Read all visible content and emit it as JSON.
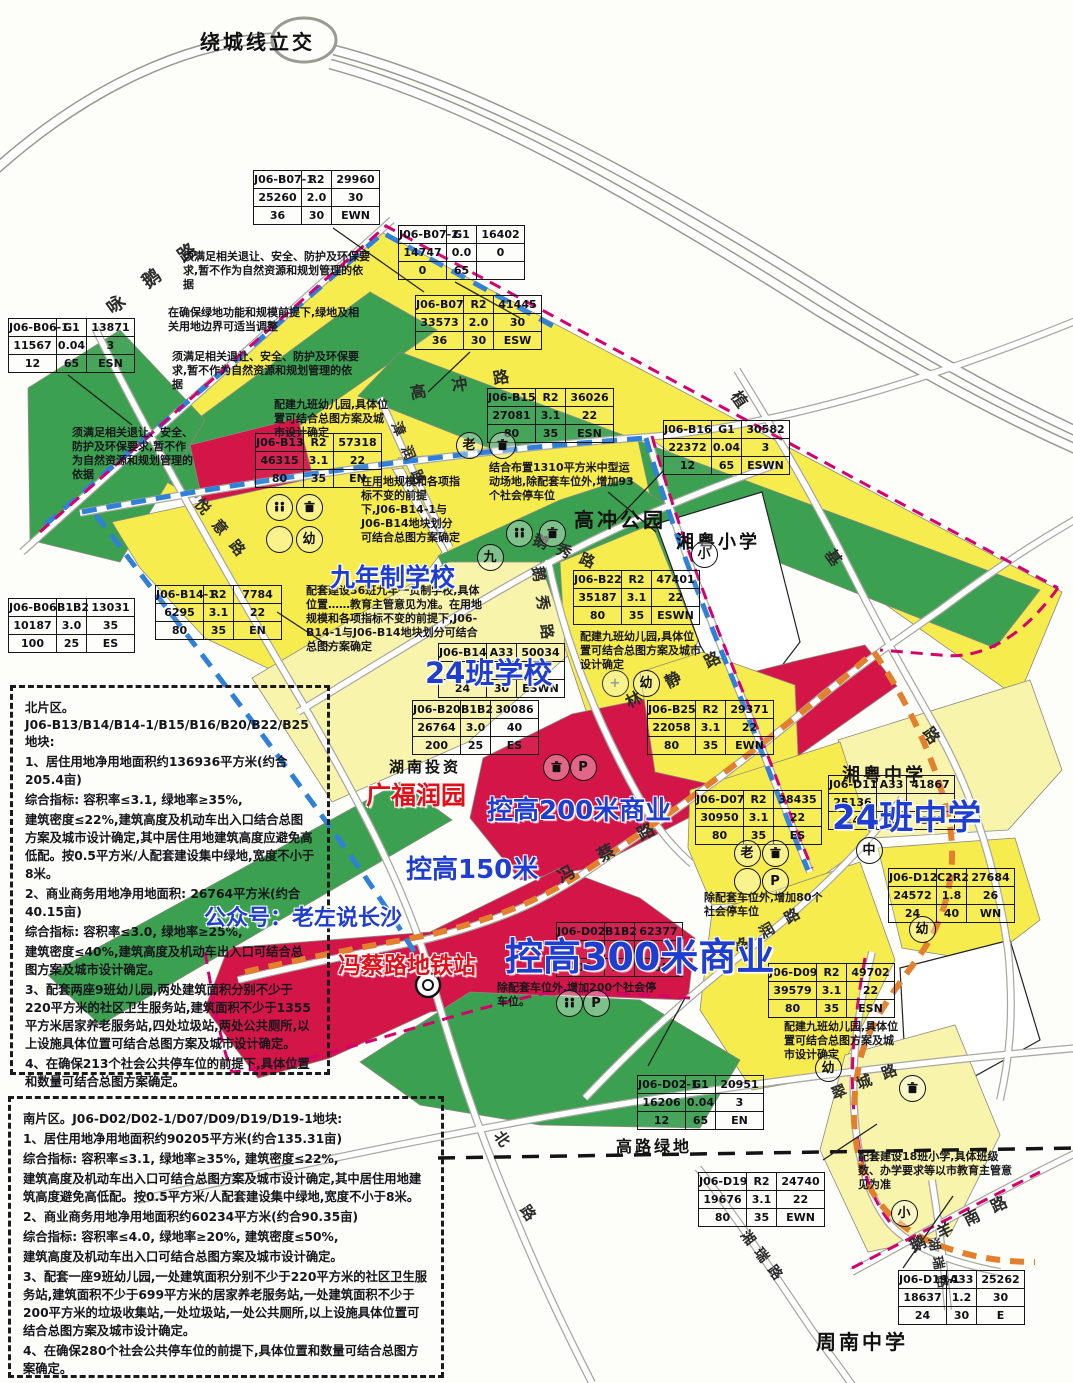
{
  "map_title": "绕城线立交",
  "colors": {
    "parcel_yellow": "#f7ec4d",
    "parcel_school": "#f8f4ac",
    "parcel_green": "#3ba050",
    "parcel_red": "#d31547",
    "boundary_blue": "#2f80d8",
    "boundary_pink": "#d4006e",
    "metro_orange": "#e2802e",
    "annotation_blue": "#1f3ed0",
    "annotation_red": "#e0101a"
  },
  "tables": [
    {
      "x": 253,
      "y": 170,
      "rows": [
        [
          "J06-B07-1",
          "R2",
          "29960"
        ],
        [
          "25260",
          "2.0",
          "30"
        ],
        [
          "36",
          "30",
          "EWN"
        ]
      ]
    },
    {
      "x": 398,
      "y": 225,
      "rows": [
        [
          "J06-B07-2",
          "G1",
          "16402"
        ],
        [
          "14747",
          "0.0",
          "0"
        ],
        [
          "0",
          "65",
          ""
        ]
      ]
    },
    {
      "x": 415,
      "y": 295,
      "rows": [
        [
          "J06-B07",
          "R2",
          "41445"
        ],
        [
          "33573",
          "2.0",
          "30"
        ],
        [
          "36",
          "30",
          "ESW"
        ]
      ]
    },
    {
      "x": 8,
      "y": 318,
      "rows": [
        [
          "J06-B06-1",
          "G1",
          "13871"
        ],
        [
          "11567",
          "0.04",
          "3"
        ],
        [
          "12",
          "65",
          "ESN"
        ]
      ]
    },
    {
      "x": 255,
      "y": 433,
      "rows": [
        [
          "J06-B13",
          "R2",
          "57318"
        ],
        [
          "46315",
          "3.1",
          "22"
        ],
        [
          "80",
          "35",
          "EN"
        ]
      ]
    },
    {
      "x": 487,
      "y": 388,
      "rows": [
        [
          "J06-B15",
          "R2",
          "36026"
        ],
        [
          "27081",
          "3.1",
          "22"
        ],
        [
          "80",
          "35",
          "ESN"
        ]
      ]
    },
    {
      "x": 663,
      "y": 420,
      "rows": [
        [
          "J06-B16",
          "G1",
          "30582"
        ],
        [
          "22372",
          "0.04",
          "3"
        ],
        [
          "12",
          "65",
          "ESWN"
        ]
      ]
    },
    {
      "x": 155,
      "y": 585,
      "rows": [
        [
          "J06-B14-1",
          "R2",
          "7784"
        ],
        [
          "6295",
          "3.1",
          "22"
        ],
        [
          "80",
          "35",
          "EN"
        ]
      ]
    },
    {
      "x": 8,
      "y": 598,
      "rows": [
        [
          "J06-B06",
          "B1B2",
          "13031"
        ],
        [
          "10187",
          "3.0",
          "35"
        ],
        [
          "100",
          "25",
          "ES"
        ]
      ]
    },
    {
      "x": 573,
      "y": 570,
      "rows": [
        [
          "J06-B22",
          "R2",
          "47401"
        ],
        [
          "35187",
          "3.1",
          "22"
        ],
        [
          "80",
          "35",
          "ESWN"
        ]
      ]
    },
    {
      "x": 438,
      "y": 643,
      "rows": [
        [
          "J06-B14",
          "A33",
          "50034"
        ],
        [
          "",
          "",
          ""
        ],
        [
          "24",
          "30",
          "ESWN"
        ]
      ]
    },
    {
      "x": 412,
      "y": 700,
      "rows": [
        [
          "J06-B20",
          "B1B2",
          "30086"
        ],
        [
          "26764",
          "3.0",
          "40"
        ],
        [
          "200",
          "25",
          "ES"
        ]
      ]
    },
    {
      "x": 647,
      "y": 700,
      "rows": [
        [
          "J06-B25",
          "R2",
          "29371"
        ],
        [
          "22058",
          "3.1",
          "22"
        ],
        [
          "80",
          "35",
          "EWN"
        ]
      ]
    },
    {
      "x": 695,
      "y": 790,
      "rows": [
        [
          "J06-D07",
          "R2",
          "38435"
        ],
        [
          "30950",
          "3.1",
          "22"
        ],
        [
          "80",
          "35",
          "ES"
        ]
      ]
    },
    {
      "x": 828,
      "y": 775,
      "rows": [
        [
          "J06-D11",
          "A33",
          "41867"
        ],
        [
          "25136",
          "",
          ""
        ],
        [
          "24",
          "30",
          "SW"
        ]
      ]
    },
    {
      "x": 888,
      "y": 868,
      "rows": [
        [
          "J06-D12",
          "C2R2",
          "27684"
        ],
        [
          "24572",
          "1.8",
          "26"
        ],
        [
          "24",
          "40",
          "WN"
        ]
      ]
    },
    {
      "x": 768,
      "y": 963,
      "rows": [
        [
          "J06-D09",
          "R2",
          "49702"
        ],
        [
          "39579",
          "3.1",
          "22"
        ],
        [
          "80",
          "35",
          "ESN"
        ]
      ]
    },
    {
      "x": 556,
      "y": 922,
      "rows": [
        [
          "J06-D02",
          "B1B2",
          "62377"
        ],
        [
          "",
          "",
          ""
        ],
        [
          "300",
          "20",
          "ESN"
        ]
      ]
    },
    {
      "x": 637,
      "y": 1075,
      "rows": [
        [
          "J06-D02-1",
          "G1",
          "20951"
        ],
        [
          "16206",
          "0.04",
          "3"
        ],
        [
          "12",
          "65",
          "EN"
        ]
      ]
    },
    {
      "x": 698,
      "y": 1172,
      "rows": [
        [
          "J06-D19",
          "R2",
          "24740"
        ],
        [
          "19676",
          "3.1",
          "22"
        ],
        [
          "80",
          "35",
          "EWN"
        ]
      ]
    },
    {
      "x": 898,
      "y": 1270,
      "rows": [
        [
          "J06-D19-1",
          "A33",
          "25262"
        ],
        [
          "18637",
          "1.2",
          "30"
        ],
        [
          "24",
          "30",
          "E"
        ]
      ]
    }
  ],
  "big_labels": [
    {
      "t": "九年制学校",
      "x": 330,
      "y": 558,
      "s": 25,
      "c": "blue"
    },
    {
      "t": "24班学校",
      "x": 425,
      "y": 650,
      "s": 29,
      "c": "blue"
    },
    {
      "t": "控高200米商业",
      "x": 487,
      "y": 790,
      "s": 26,
      "c": "blue"
    },
    {
      "t": "控高150米",
      "x": 406,
      "y": 849,
      "s": 26,
      "c": "blue"
    },
    {
      "t": "控高300米商业",
      "x": 505,
      "y": 926,
      "s": 38,
      "c": "blue"
    },
    {
      "t": "24班中学",
      "x": 832,
      "y": 790,
      "s": 34,
      "c": "blue"
    },
    {
      "t": "公众号：老左说长沙",
      "x": 204,
      "y": 900,
      "s": 22,
      "c": "blue"
    },
    {
      "t": "广福润园",
      "x": 366,
      "y": 776,
      "s": 25,
      "c": "red"
    },
    {
      "t": "冯蔡路地铁站",
      "x": 338,
      "y": 946,
      "s": 23,
      "c": "red"
    }
  ],
  "area_labels": [
    {
      "t": "绕城线立交",
      "x": 200,
      "y": 26,
      "s": 20
    },
    {
      "t": "高冲公园",
      "x": 574,
      "y": 504,
      "s": 20
    },
    {
      "t": "湘粤小学",
      "x": 676,
      "y": 528,
      "s": 18
    },
    {
      "t": "湘粤中学",
      "x": 842,
      "y": 761,
      "s": 18
    },
    {
      "t": "周南中学",
      "x": 816,
      "y": 1326,
      "s": 20
    },
    {
      "t": "高路绿地",
      "x": 616,
      "y": 1133,
      "s": 16
    },
    {
      "t": "湖南投资",
      "x": 389,
      "y": 756,
      "s": 15
    }
  ],
  "road_labels": [
    {
      "t": "咏鹅路",
      "x": 108,
      "y": 296,
      "s": 18,
      "r": -36,
      "ls": 26
    },
    {
      "t": "悦意路",
      "x": 198,
      "y": 490,
      "s": 15,
      "r": 50,
      "ls": 12
    },
    {
      "t": "高冲路",
      "x": 410,
      "y": 380,
      "s": 16,
      "r": -10,
      "ls": 26
    },
    {
      "t": "漳润路",
      "x": 396,
      "y": 412,
      "s": 14,
      "r": 68,
      "ls": 12
    },
    {
      "t": "鹅秀路",
      "x": 534,
      "y": 528,
      "s": 15,
      "r": 22,
      "ls": 10
    },
    {
      "t": "鹅秀路",
      "x": 538,
      "y": 556,
      "s": 15,
      "r": 82,
      "ls": 14
    },
    {
      "t": "林静路",
      "x": 626,
      "y": 690,
      "s": 16,
      "r": -27,
      "ls": 28
    },
    {
      "t": "植",
      "x": 736,
      "y": 380,
      "s": 16,
      "r": 55,
      "ls": 0
    },
    {
      "t": "基",
      "x": 830,
      "y": 538,
      "s": 16,
      "r": 55,
      "ls": 0
    },
    {
      "t": "路",
      "x": 928,
      "y": 716,
      "s": 16,
      "r": 55,
      "ls": 0
    },
    {
      "t": "冯蔡路",
      "x": 558,
      "y": 864,
      "s": 17,
      "r": -28,
      "ls": 28
    },
    {
      "t": "格润路",
      "x": 735,
      "y": 938,
      "s": 15,
      "r": -30,
      "ls": 14
    },
    {
      "t": "翠城路",
      "x": 832,
      "y": 1084,
      "s": 15,
      "r": -22,
      "ls": 12
    },
    {
      "t": "鹅羊南路",
      "x": 910,
      "y": 1234,
      "s": 16,
      "r": -26,
      "ls": 14
    },
    {
      "t": "湘瑞路",
      "x": 744,
      "y": 1222,
      "s": 14,
      "r": 52,
      "ls": 8
    },
    {
      "t": "湖瑞路",
      "x": 934,
      "y": 1228,
      "s": 13,
      "r": 78,
      "ls": 6
    },
    {
      "t": "北",
      "x": 498,
      "y": 1122,
      "s": 15,
      "r": 55,
      "ls": 0
    },
    {
      "t": "路",
      "x": 524,
      "y": 1196,
      "s": 15,
      "r": 55,
      "ls": 0
    }
  ],
  "notes": [
    {
      "t": "须满足相关退让、安全、防护及环保要求,暂不作为自然资源和规划管理的依据",
      "x": 183,
      "y": 250,
      "w": 190
    },
    {
      "t": "在确保绿地功能和规模前提下,绿地及相关用地边界可适当调整",
      "x": 168,
      "y": 306,
      "w": 195
    },
    {
      "t": "须满足相关退让、安全、防护及环保要求,暂不作为自然资源和规划管理的依据",
      "x": 172,
      "y": 350,
      "w": 188
    },
    {
      "t": "须满足相关退让、安全、防护及环保要求,暂不作为自然资源和规划管理的依据",
      "x": 72,
      "y": 426,
      "w": 122
    },
    {
      "t": "配建九班幼儿园,具体位置可结合总图方案及城市设计确定",
      "x": 274,
      "y": 398,
      "w": 120
    },
    {
      "t": "在用地规模和各项指标不变的前提下,J06-B14-1与J06-B14地块划分可结合总图方案确定",
      "x": 361,
      "y": 475,
      "w": 102
    },
    {
      "t": "结合布置1310平方米中型运动场地,除配套车位外,增加93个社会停车位",
      "x": 489,
      "y": 461,
      "w": 150
    },
    {
      "t": "配套建设36班九年一贯制学校,具体位置……教育主管意见为准。在用地规模和各项指标不变的前提下,J06-B14-1与J06-B14地块划分可结合总图方案确定",
      "x": 306,
      "y": 584,
      "w": 182
    },
    {
      "t": "配建九班幼儿园,具体位置可结合总图方案及城市设计确定",
      "x": 580,
      "y": 630,
      "w": 122
    },
    {
      "t": "除配套车位外,增加80个社会停车位",
      "x": 704,
      "y": 891,
      "w": 126
    },
    {
      "t": "除配套车位外,增加200个社会停车位。",
      "x": 497,
      "y": 981,
      "w": 168
    },
    {
      "t": "配建九班幼儿园,具体位置可结合总图方案及城市设计确定",
      "x": 784,
      "y": 1020,
      "w": 118
    },
    {
      "t": "配套建设18班小学,具体班级数、办学要求等以市教育主管意见为准",
      "x": 858,
      "y": 1150,
      "w": 160
    }
  ],
  "zones": {
    "north": {
      "x": 10,
      "y": 685,
      "w": 320,
      "h": 390,
      "fs": 12.3,
      "paras": [
        "北片区。",
        "J06-B13/B14/B14-1/B15/B16/B20/B22/B25地块:",
        "1、居住用地净用地面积约136936平方米(约合205.4亩)",
        "综合指标: 容积率≤3.1, 绿地率≥35%,",
        "建筑密度≤22%,建筑高度及机动车出入口结合总图方案及城市设计确定,其中居住用地建筑高度应避免高低配。按0.5平方米/人配套建设集中绿地,宽度不小于8米。",
        "2、商业商务用地净用地面积: 26764平方米(约合40.15亩)",
        "综合指标: 容积率≤3.0, 绿地率≥25%,",
        "建筑密度≤40%,建筑高度及机动车出入口可结合总图方案及城市设计确定。",
        "3、配套两座9班幼儿园,两处建筑面积分别不少于220平方米的社区卫生服务站,建筑面积不少于1355平方米居家养老服务站,四处垃圾站,两处公共厕所,以上设施具体位置可结合总图方案及城市设计确定。",
        "4、在确保213个社会公共停车位的前提下,具体位置和数量可结合总图方案确定。"
      ]
    },
    "south": {
      "x": 8,
      "y": 1096,
      "w": 436,
      "h": 282,
      "fs": 12.3,
      "paras": [
        "南片区。J06-D02/D02-1/D07/D09/D19/D19-1地块:",
        "1、居住用地净用地面积约90205平方米(约合135.31亩)",
        "综合指标: 容积率≤3.1, 绿地率≥35%, 建筑密度≤22%,",
        "建筑高度及机动车出入口可结合总图方案及城市设计确定,其中居住用地建筑高度避免高低配。按0.5平方米/人配套建设集中绿地,宽度不小于8米。",
        "2、商业商务用地净用地面积约60234平方米(约合90.35亩)",
        "综合指标: 容积率≤4.0, 绿地率≥20%, 建筑密度≤50%,",
        "建筑高度及机动车出入口可结合总图方案及城市设计确定。",
        "3、配套一座9班幼儿园,一处建筑面积分别不少于220平方米的社区卫生服务站,建筑面积不少于699平方米的居家养老服务站,一处建筑面积不少于200平方米的垃圾收集站,一处垃圾站,一处公共厕所,以上设施具体位置可结合总图方案及城市设计确定。",
        "4、在确保280个社会公共停车位的前提下,具体位置和数量可结合总图方案确定。"
      ]
    }
  },
  "icons": [
    {
      "g": "wc",
      "x": 278,
      "y": 506
    },
    {
      "g": "bin",
      "x": 308,
      "y": 506
    },
    {
      "g": "",
      "x": 278,
      "y": 538
    },
    {
      "g": "幼",
      "x": 308,
      "y": 538
    },
    {
      "g": "老",
      "x": 468,
      "y": 444
    },
    {
      "g": "bin",
      "x": 501,
      "y": 444
    },
    {
      "g": "wc",
      "x": 518,
      "y": 532
    },
    {
      "g": "bin",
      "x": 551,
      "y": 532
    },
    {
      "g": "plus",
      "x": 614,
      "y": 682
    },
    {
      "g": "幼",
      "x": 645,
      "y": 682
    },
    {
      "g": "小",
      "x": 703,
      "y": 553
    },
    {
      "g": "九",
      "x": 489,
      "y": 556
    },
    {
      "g": "bin",
      "x": 555,
      "y": 766
    },
    {
      "g": "P",
      "x": 582,
      "y": 766
    },
    {
      "g": "老",
      "x": 746,
      "y": 852
    },
    {
      "g": "bin",
      "x": 774,
      "y": 852
    },
    {
      "g": "",
      "x": 746,
      "y": 880
    },
    {
      "g": "P",
      "x": 774,
      "y": 880
    },
    {
      "g": "中",
      "x": 868,
      "y": 849
    },
    {
      "g": "幼",
      "x": 921,
      "y": 928
    },
    {
      "g": "幼",
      "x": 827,
      "y": 1067
    },
    {
      "g": "wc",
      "x": 568,
      "y": 1002
    },
    {
      "g": "P",
      "x": 595,
      "y": 1002
    },
    {
      "g": "bin",
      "x": 911,
      "y": 1087
    },
    {
      "g": "小",
      "x": 903,
      "y": 1212
    }
  ],
  "station": {
    "x": 428,
    "y": 985,
    "name": "metro-station-marker"
  }
}
